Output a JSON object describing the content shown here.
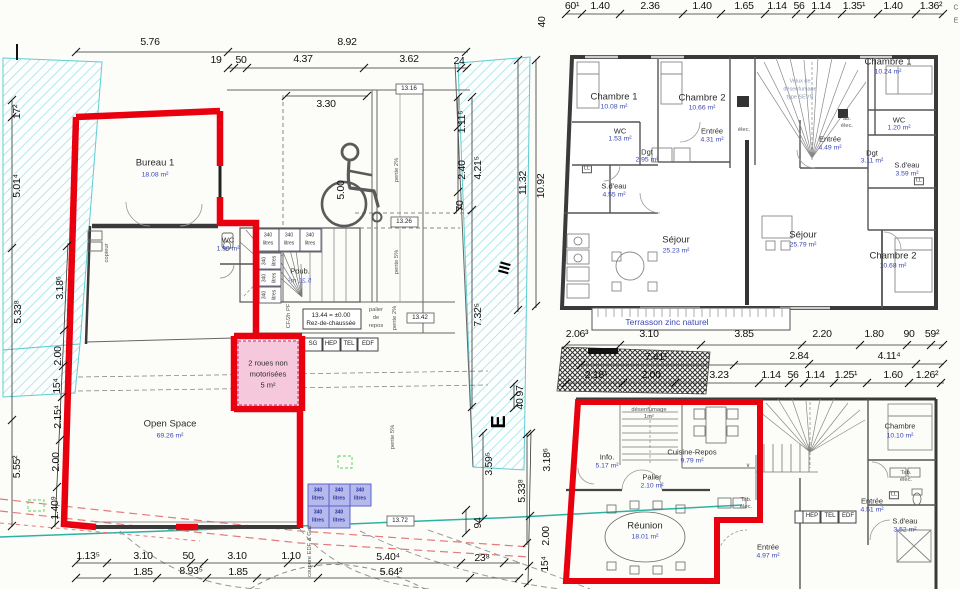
{
  "colors": {
    "outline_red": "#e8000f",
    "room_pink": "#f6c8dc",
    "bin_blue": "#b5b9ec",
    "area_text_blue": "#3947b5",
    "boundary_cyan": "#7fd4d8",
    "utility_teal": "#2ab3a3",
    "marking_red_dashed": "#e37b7b"
  },
  "ground_floor": {
    "dims_top_a": [
      "5.76",
      "8.92"
    ],
    "dims_top_b": [
      "19",
      "50",
      "4.37",
      "3.62",
      "24"
    ],
    "dims_mid": [
      "3.30",
      "5.00",
      "11.32",
      "10.92"
    ],
    "dims_right": [
      "1.11⁵",
      "2.40",
      "4.21⁵",
      "70",
      "7.32⁵",
      "3.59⁵",
      "94",
      "5.33⁸",
      "97",
      "40"
    ],
    "dims_left_outer": [
      "17²",
      "5.01⁴",
      "5.33⁸",
      "5.55²"
    ],
    "dims_left_inner": [
      "3.18⁶",
      "2.00",
      "15⁴",
      "2.15⁴",
      "2.00",
      "1.40⁹"
    ],
    "dims_bottom_a": [
      "1.13⁵",
      "3.10",
      "50",
      "3.10",
      "1.10",
      "5.40⁴",
      "23⁸"
    ],
    "dims_bottom_b": [
      "1.85",
      "8.93⁵",
      "1.85",
      "5.64²"
    ],
    "levels": [
      "13.16",
      "13.26",
      "13.42",
      "13.72"
    ],
    "level_box": {
      "value": "13.44 = ±0.00",
      "name": "Rez-de-chaussée"
    },
    "rooms": {
      "bureau": {
        "name": "Bureau 1",
        "area": "18.08 m²"
      },
      "wc": {
        "name": "WC",
        "area": "1.90 m²"
      },
      "poub": {
        "name": "Poub.",
        "area": "5.21 m²"
      },
      "bike": {
        "line1": "2 roues non",
        "line2": "motorisées",
        "line3": "5 m²"
      },
      "open_space": {
        "name": "Open Space",
        "area": "69.26 m²"
      }
    },
    "palier_repos": {
      "line1": "palier",
      "line2": "de",
      "line3": "repos"
    },
    "slopes": {
      "pente2": "pente 2%",
      "pente5": "pente 5%"
    },
    "utility_boxes": [
      "SG",
      "HEP",
      "TEL",
      "EDF"
    ],
    "bin": {
      "volume": "340",
      "unit": "litres"
    },
    "annotations": {
      "cf": "CF/2h PF",
      "copieur": "copieur",
      "coupure": "coupure EDF & Gaz"
    }
  },
  "first_floor": {
    "dims_top": [
      "60¹",
      "1.40",
      "2.36",
      "1.40",
      "1.65",
      "1.14",
      "56",
      "1.14",
      "1.35¹",
      "1.40",
      "1.36²"
    ],
    "dim_left": "40",
    "dims_bottom": [
      "2.06³",
      "3.10",
      "3.85",
      "2.20",
      "1.80",
      "90",
      "59²"
    ],
    "rooms": {
      "chambre1_l": {
        "name": "Chambre 1",
        "area": "10.08 m²"
      },
      "chambre2_l": {
        "name": "Chambre 2",
        "area": "10.66 m²"
      },
      "chambre1_r": {
        "name": "Chambre 1",
        "area": "10.24 m²"
      },
      "wc_l": {
        "name": "WC",
        "area": "1.53 m²"
      },
      "dgt_l": {
        "name": "Dgt",
        "area": "2.95 m²"
      },
      "entree_l": {
        "name": "Entrée",
        "area": "4.31 m²"
      },
      "sdeau_l": {
        "name": "S.d'eau",
        "area": "4.55 m²"
      },
      "entree_r": {
        "name": "Entrée",
        "area": "4.49 m²"
      },
      "wc_r": {
        "name": "WC",
        "area": "1.20 m²"
      },
      "dgt_r": {
        "name": "Dgt",
        "area": "3.11 m²"
      },
      "sdeau_r": {
        "name": "S.d'eau",
        "area": "3.59 m²"
      },
      "sejour_l": {
        "name": "Séjour",
        "area": "25.23 m²"
      },
      "sejour_r": {
        "name": "Séjour",
        "area": "25.79 m²"
      },
      "chambre2_r": {
        "name": "Chambre 2",
        "area": "10.68 m²"
      }
    },
    "velux": {
      "line1": "Velux de",
      "line2": "désenfumage",
      "line3": "type SEVN"
    },
    "terrasson": "Terrasson zinc naturel",
    "small": {
      "elec": "élec.",
      "ab": "ab.",
      "ll": "LL"
    }
  },
  "second_floor": {
    "dims_top_a": [
      "7.41¹",
      "2.84",
      "4.11⁴"
    ],
    "dims_top_b": [
      "2.18¹",
      "2.00",
      "3.23",
      "1.14",
      "56",
      "1.14",
      "1.25¹",
      "1.60",
      "1.26²"
    ],
    "dims_left": [
      "3.18⁶",
      "2.00",
      "15⁴"
    ],
    "rooms": {
      "info": {
        "name": "Info.",
        "area": "5.17 m²"
      },
      "palier": {
        "name": "Palier",
        "area": "2.10 m²"
      },
      "cuisine": {
        "name": "Cuisine-Repos",
        "area": "9.79 m²"
      },
      "reunion": {
        "name": "Réunion",
        "area": "18.01 m²"
      },
      "entree_c": {
        "name": "Entrée",
        "area": "4.97 m²"
      },
      "entree_r": {
        "name": "Entrée",
        "area": "4.51 m²"
      },
      "sdeau": {
        "name": "S.d'eau",
        "area": "3.52 m²"
      },
      "chambre": {
        "name": "Chambre",
        "area": "10.10 m²"
      }
    },
    "desenfumage": {
      "line1": "désenfumage",
      "line2": "1m²"
    },
    "utility_boxes": [
      "HEP",
      "TEL",
      "EDF"
    ],
    "small": {
      "tab": "Tab.",
      "elec": "élec.",
      "ll": "LL"
    }
  },
  "markers": {
    "section_a": "III",
    "section_b": "E",
    "edge_c": "C",
    "edge_e": "E",
    "stair_arrow": "∨"
  }
}
